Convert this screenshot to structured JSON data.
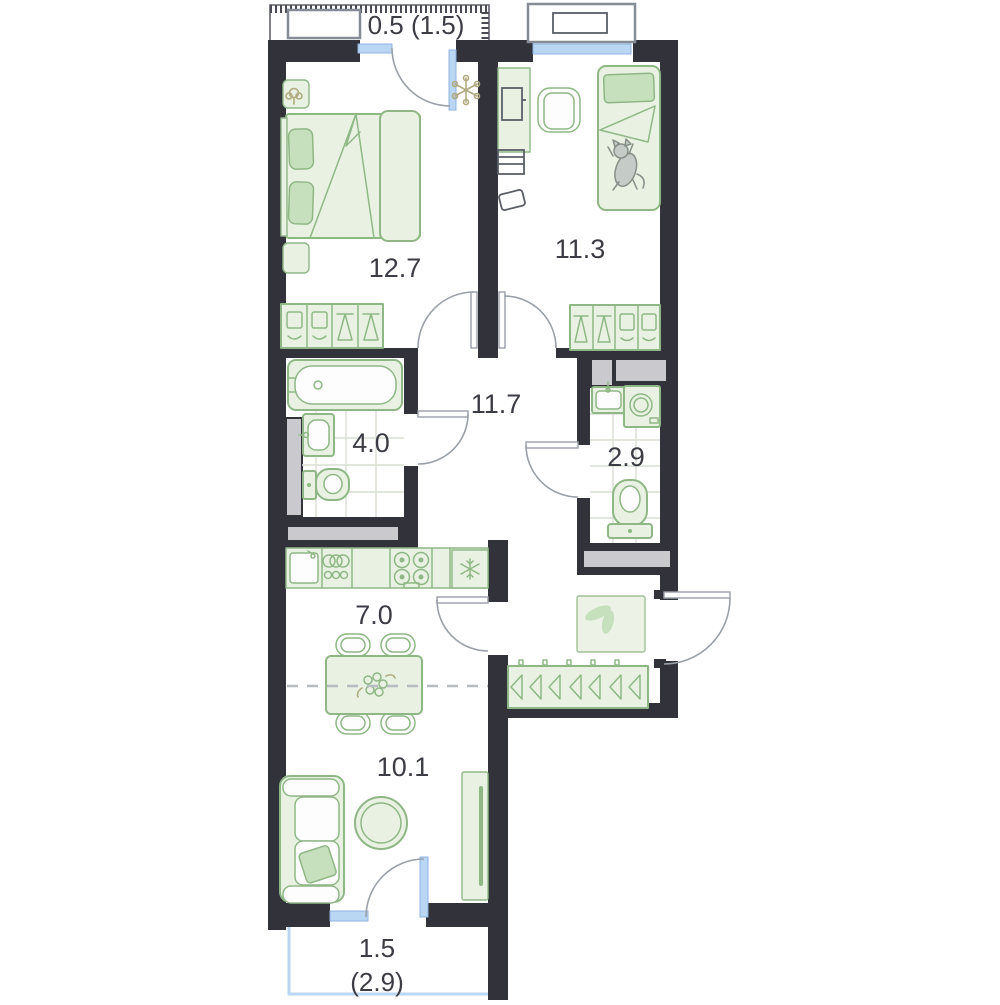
{
  "plan_type": "apartment-floor-plan",
  "rooms": {
    "balcony_top": {
      "label": "0.5 (1.5)"
    },
    "bedroom": {
      "label": "12.7"
    },
    "children_room": {
      "label": "11.3"
    },
    "hallway": {
      "label": "11.7"
    },
    "bathroom": {
      "label": "4.0"
    },
    "toilet_room": {
      "label": "2.9"
    },
    "kitchen": {
      "label": "7.0"
    },
    "living_room": {
      "label": "10.1"
    },
    "balcony_bottom": {
      "label_line1": "1.5",
      "label_line2": "(2.9)"
    }
  },
  "colors": {
    "background": "#ffffff",
    "wall": "#32323a",
    "furniture_fill": "#e9f2e2",
    "furniture_fill_dark": "#c6dfbc",
    "furniture_stroke": "#8fb786",
    "window_blue": "#b9d6f2",
    "window_blue_stroke": "#8fb4e0",
    "door_stroke": "#9aa0a8",
    "shaft_gray": "#c9c9ce",
    "tile_line": "#d8dfd4",
    "label_text": "#3c3c44",
    "dashed_divider": "#b7bcc0",
    "plant_olive": "#b0ab80",
    "cat_gray": "#c5ccc7"
  }
}
